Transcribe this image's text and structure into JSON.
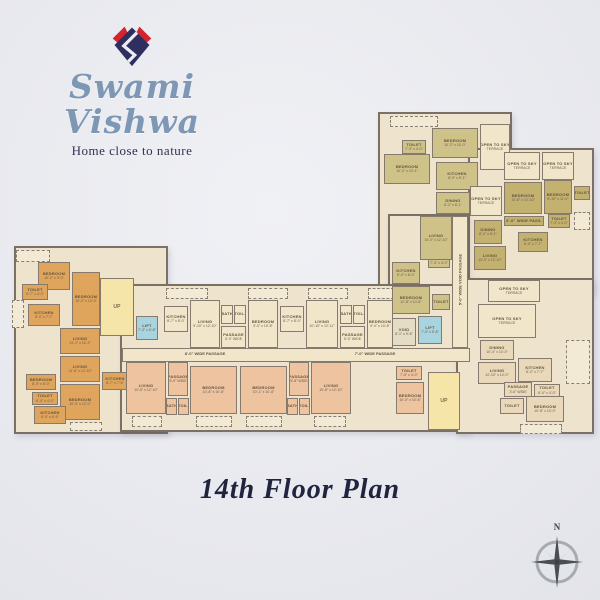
{
  "brand": {
    "name": "Swami Vishwa",
    "tagline": "Home close to nature",
    "logo_navy": "#2e2f5e",
    "logo_red": "#d6232d"
  },
  "title": "14th Floor Plan",
  "compass": {
    "north_label": "N"
  },
  "palette": {
    "or": "#dfa55c",
    "cr": "#f1e5ca",
    "sa": "#edc3a0",
    "ol": "#cfc289",
    "kh": "#c3b170",
    "tn": "#e9d9ba",
    "st": "#f6e5a9",
    "lf": "#a7d4df",
    "vd": "#e5dcc6"
  },
  "plan": {
    "slabs": [
      {
        "x": 378,
        "y": 112,
        "w": 134,
        "h": 176
      },
      {
        "x": 468,
        "y": 148,
        "w": 126,
        "h": 146
      },
      {
        "x": 388,
        "y": 214,
        "w": 80,
        "h": 74
      },
      {
        "x": 14,
        "y": 246,
        "w": 154,
        "h": 188
      },
      {
        "x": 120,
        "y": 284,
        "w": 350,
        "h": 148
      },
      {
        "x": 456,
        "y": 278,
        "w": 138,
        "h": 156
      }
    ],
    "rooms": [
      {
        "l": "BEDROOM",
        "d": "10'-2\" x 9'-0\"",
        "x": 38,
        "y": 262,
        "w": 32,
        "h": 28,
        "f": "or"
      },
      {
        "l": "BEDROOM",
        "d": "10'-2\" x 13'-0\"",
        "x": 72,
        "y": 272,
        "w": 28,
        "h": 54,
        "f": "or"
      },
      {
        "l": "TOILET",
        "d": "6'-7\" x 4'-0\"",
        "x": 22,
        "y": 284,
        "w": 26,
        "h": 16,
        "f": "or"
      },
      {
        "l": "KITCHEN",
        "d": "8'-0\" x 7'-7\"",
        "x": 28,
        "y": 304,
        "w": 32,
        "h": 22,
        "f": "or"
      },
      {
        "l": "LIVING",
        "d": "13'-1\" x 16'-2\"",
        "x": 60,
        "y": 328,
        "w": 40,
        "h": 26,
        "f": "or"
      },
      {
        "l": "LIVING",
        "d": "13'-8\" x 12'-10\"",
        "x": 60,
        "y": 356,
        "w": 40,
        "h": 26,
        "f": "or"
      },
      {
        "l": "BEDROOM",
        "d": "10'-9\" x 12'-0\"",
        "x": 60,
        "y": 384,
        "w": 40,
        "h": 36,
        "f": "or"
      },
      {
        "l": "BEDROOM",
        "d": "8'-0\" x 8'-0\"",
        "x": 26,
        "y": 374,
        "w": 30,
        "h": 16,
        "f": "or"
      },
      {
        "l": "TOILET",
        "d": "6'-0\" x 4'-0\"",
        "x": 32,
        "y": 392,
        "w": 26,
        "h": 13,
        "f": "or"
      },
      {
        "l": "KITCHEN",
        "d": "8'-0\" x 6'-6\"",
        "x": 34,
        "y": 406,
        "w": 32,
        "h": 18,
        "f": "or"
      },
      {
        "l": "KITCHEN",
        "d": "8'-7\" x 7'-5\"",
        "x": 102,
        "y": 372,
        "w": 26,
        "h": 18,
        "f": "or"
      },
      {
        "l": "UP",
        "d": "",
        "x": 100,
        "y": 278,
        "w": 34,
        "h": 58,
        "f": "st",
        "kind": "stair"
      },
      {
        "l": "LIFT",
        "d": "7'-3\" x 5'-8\"",
        "x": 136,
        "y": 316,
        "w": 22,
        "h": 24,
        "f": "lf"
      },
      {
        "l": "KITCHEN",
        "d": "8'-7\" x 8'-0\"",
        "x": 164,
        "y": 306,
        "w": 24,
        "h": 26,
        "f": "cr"
      },
      {
        "l": "LIVING",
        "d": "9'-10\" x 12'-10\"",
        "x": 190,
        "y": 300,
        "w": 30,
        "h": 48,
        "f": "cr"
      },
      {
        "l": "BATH",
        "d": "",
        "x": 221,
        "y": 305,
        "w": 12,
        "h": 19,
        "f": "cr"
      },
      {
        "l": "TOIL.",
        "d": "",
        "x": 234,
        "y": 305,
        "w": 12,
        "h": 19,
        "f": "cr"
      },
      {
        "l": "PASSAGE",
        "d": "5'-0\" WIDE",
        "x": 221,
        "y": 326,
        "w": 25,
        "h": 22,
        "f": "cr"
      },
      {
        "l": "BEDROOM",
        "d": "9'-0\" x 10'-8\"",
        "x": 248,
        "y": 300,
        "w": 30,
        "h": 48,
        "f": "cr"
      },
      {
        "l": "KITCHEN",
        "d": "8'-7\" x 8'-0\"",
        "x": 280,
        "y": 306,
        "w": 24,
        "h": 26,
        "f": "cr"
      },
      {
        "l": "LIVING",
        "d": "10'-10\" x 12'-11\"",
        "x": 306,
        "y": 300,
        "w": 32,
        "h": 48,
        "f": "cr"
      },
      {
        "l": "BATH",
        "d": "",
        "x": 340,
        "y": 305,
        "w": 12,
        "h": 19,
        "f": "cr"
      },
      {
        "l": "TOIL.",
        "d": "",
        "x": 353,
        "y": 305,
        "w": 12,
        "h": 19,
        "f": "cr"
      },
      {
        "l": "PASSAGE",
        "d": "5'-0\" WIDE",
        "x": 340,
        "y": 326,
        "w": 25,
        "h": 22,
        "f": "cr"
      },
      {
        "l": "BEDROOM",
        "d": "9'-0\" x 10'-8\"",
        "x": 367,
        "y": 300,
        "w": 26,
        "h": 48,
        "f": "cr"
      },
      {
        "l": "",
        "d": "",
        "x": 122,
        "y": 348,
        "w": 348,
        "h": 14,
        "f": "cr"
      },
      {
        "l": "LIVING",
        "d": "10'-8\" x 12'-10\"",
        "x": 126,
        "y": 362,
        "w": 40,
        "h": 52,
        "f": "sa"
      },
      {
        "l": "PASSAGE",
        "d": "5'-0\" WIDE",
        "x": 168,
        "y": 362,
        "w": 20,
        "h": 34,
        "f": "sa"
      },
      {
        "l": "BATH",
        "d": "",
        "x": 166,
        "y": 398,
        "w": 11,
        "h": 17,
        "f": "sa"
      },
      {
        "l": "TOIL.",
        "d": "",
        "x": 178,
        "y": 398,
        "w": 11,
        "h": 17,
        "f": "sa"
      },
      {
        "l": "BEDROOM",
        "d": "10'-8\" x 10'-8\"",
        "x": 190,
        "y": 366,
        "w": 47,
        "h": 48,
        "f": "sa"
      },
      {
        "l": "BEDROOM",
        "d": "10'-1\" x 10'-8\"",
        "x": 240,
        "y": 366,
        "w": 47,
        "h": 48,
        "f": "sa"
      },
      {
        "l": "PASSAGE",
        "d": "5'-8\" WIDE",
        "x": 289,
        "y": 362,
        "w": 20,
        "h": 34,
        "f": "sa"
      },
      {
        "l": "BATH",
        "d": "",
        "x": 287,
        "y": 398,
        "w": 11,
        "h": 17,
        "f": "sa"
      },
      {
        "l": "TOIL.",
        "d": "",
        "x": 299,
        "y": 398,
        "w": 11,
        "h": 17,
        "f": "sa"
      },
      {
        "l": "LIVING",
        "d": "10'-8\" x 12'-10\"",
        "x": 311,
        "y": 362,
        "w": 40,
        "h": 52,
        "f": "sa"
      },
      {
        "l": "TOILET",
        "d": "7'-5\" x 4'-0\"",
        "x": 396,
        "y": 366,
        "w": 26,
        "h": 14,
        "f": "sa"
      },
      {
        "l": "BEDROOM",
        "d": "10'-0\" x 10'-6\"",
        "x": 396,
        "y": 382,
        "w": 28,
        "h": 32,
        "f": "sa"
      },
      {
        "l": "UP",
        "d": "",
        "x": 428,
        "y": 372,
        "w": 32,
        "h": 58,
        "f": "st",
        "kind": "stair"
      },
      {
        "l": "KITCHEN",
        "d": "8'-0\" x 8'-0\"",
        "x": 392,
        "y": 262,
        "w": 28,
        "h": 22,
        "f": "ol"
      },
      {
        "l": "TOILET",
        "d": "7'-3\" x 4'-0\"",
        "x": 428,
        "y": 254,
        "w": 22,
        "h": 14,
        "f": "ol"
      },
      {
        "l": "BEDROOM",
        "d": "11'-8\" x 10'-8\"",
        "x": 392,
        "y": 286,
        "w": 38,
        "h": 28,
        "f": "ol"
      },
      {
        "l": "TOILET",
        "d": "",
        "x": 432,
        "y": 294,
        "w": 18,
        "h": 16,
        "f": "ol"
      },
      {
        "l": "VOID",
        "d": "8'-1\" x 9'-8\"",
        "x": 392,
        "y": 318,
        "w": 24,
        "h": 28,
        "f": "vd"
      },
      {
        "l": "LIFT",
        "d": "7'-3\" x 5'-8\"",
        "x": 418,
        "y": 316,
        "w": 24,
        "h": 28,
        "f": "lf"
      },
      {
        "l": "",
        "d": "",
        "x": 452,
        "y": 216,
        "w": 16,
        "h": 132,
        "f": "cr"
      },
      {
        "l": "BEDROOM",
        "d": "10'-2\" x 10'-0\"",
        "x": 432,
        "y": 128,
        "w": 46,
        "h": 30,
        "f": "ol"
      },
      {
        "l": "TOILET",
        "d": "7'-3\" x 4'-0\"",
        "x": 402,
        "y": 140,
        "w": 24,
        "h": 14,
        "f": "ol"
      },
      {
        "l": "BEDROOM",
        "d": "10'-2\" x 10'-1\"",
        "x": 384,
        "y": 154,
        "w": 46,
        "h": 30,
        "f": "ol"
      },
      {
        "l": "KITCHEN",
        "d": "8'-0\" x 8'-1\"",
        "x": 436,
        "y": 162,
        "w": 42,
        "h": 28,
        "f": "ol"
      },
      {
        "l": "DINING",
        "d": "8'-2\" x 8'-1\"",
        "x": 436,
        "y": 192,
        "w": 34,
        "h": 22,
        "f": "ol"
      },
      {
        "l": "LIVING",
        "d": "10'-0\" x 12'-10\"",
        "x": 420,
        "y": 216,
        "w": 32,
        "h": 44,
        "f": "ol"
      },
      {
        "l": "OPEN TO SKY",
        "d": "TERRACE",
        "x": 480,
        "y": 124,
        "w": 30,
        "h": 46,
        "f": "cr"
      },
      {
        "l": "OPEN TO SKY",
        "d": "TERRACE",
        "x": 504,
        "y": 152,
        "w": 36,
        "h": 28,
        "f": "cr"
      },
      {
        "l": "OPEN TO SKY",
        "d": "TERRACE",
        "x": 542,
        "y": 152,
        "w": 32,
        "h": 28,
        "f": "cr"
      },
      {
        "l": "OPEN TO SKY",
        "d": "TERRACE",
        "x": 470,
        "y": 186,
        "w": 32,
        "h": 30,
        "f": "cr"
      },
      {
        "l": "BEDROOM",
        "d": "10'-8\" x 10'-10\"",
        "x": 504,
        "y": 182,
        "w": 38,
        "h": 32,
        "f": "kh"
      },
      {
        "l": "BEDROOM",
        "d": "8'-10\" x 11'-0\"",
        "x": 544,
        "y": 180,
        "w": 28,
        "h": 34,
        "f": "kh"
      },
      {
        "l": "TOILET",
        "d": "",
        "x": 574,
        "y": 186,
        "w": 16,
        "h": 14,
        "f": "kh"
      },
      {
        "l": "3'-0\" WIDE PASS.",
        "d": "",
        "x": 504,
        "y": 216,
        "w": 40,
        "h": 10,
        "f": "kh"
      },
      {
        "l": "TOILET",
        "d": "7'-3\" x 4'-0\"",
        "x": 548,
        "y": 214,
        "w": 22,
        "h": 14,
        "f": "kh"
      },
      {
        "l": "DINING",
        "d": "8'-2\" x 8'-1\"",
        "x": 474,
        "y": 220,
        "w": 28,
        "h": 24,
        "f": "kh"
      },
      {
        "l": "KITCHEN",
        "d": "8'-0\" x 7'-7\"",
        "x": 518,
        "y": 232,
        "w": 30,
        "h": 20,
        "f": "kh"
      },
      {
        "l": "LIVING",
        "d": "10'-0\" x 12'-10\"",
        "x": 474,
        "y": 246,
        "w": 32,
        "h": 24,
        "f": "kh"
      },
      {
        "l": "OPEN TO SKY",
        "d": "TERRACE",
        "x": 488,
        "y": 280,
        "w": 52,
        "h": 22,
        "f": "cr"
      },
      {
        "l": "OPEN TO SKY",
        "d": "TERRACE",
        "x": 478,
        "y": 304,
        "w": 58,
        "h": 34,
        "f": "cr"
      },
      {
        "l": "DINING",
        "d": "10'-4\" x 10'-0\"",
        "x": 480,
        "y": 340,
        "w": 34,
        "h": 20,
        "f": "tn"
      },
      {
        "l": "LIVING",
        "d": "10'-10\" x 10'-0\"",
        "x": 478,
        "y": 362,
        "w": 38,
        "h": 22,
        "f": "tn"
      },
      {
        "l": "KITCHEN",
        "d": "8'-2\" x 7'-7\"",
        "x": 518,
        "y": 358,
        "w": 34,
        "h": 24,
        "f": "tn"
      },
      {
        "l": "TOILET",
        "d": "6'-0\" x 4'-0\"",
        "x": 534,
        "y": 384,
        "w": 26,
        "h": 13,
        "f": "tn"
      },
      {
        "l": "PASSAGE",
        "d": "3'-6\" WIDE",
        "x": 504,
        "y": 382,
        "w": 28,
        "h": 15,
        "f": "tn"
      },
      {
        "l": "TOILET",
        "d": "",
        "x": 500,
        "y": 398,
        "w": 24,
        "h": 16,
        "f": "tn"
      },
      {
        "l": "BEDROOM",
        "d": "10'-8\" x 10'-0\"",
        "x": 526,
        "y": 396,
        "w": 38,
        "h": 26,
        "f": "tn"
      }
    ],
    "balconies": [
      {
        "x": 16,
        "y": 250,
        "w": 34,
        "h": 12
      },
      {
        "x": 12,
        "y": 300,
        "w": 12,
        "h": 28
      },
      {
        "x": 166,
        "y": 288,
        "w": 42,
        "h": 11
      },
      {
        "x": 248,
        "y": 288,
        "w": 40,
        "h": 11
      },
      {
        "x": 308,
        "y": 288,
        "w": 40,
        "h": 11
      },
      {
        "x": 368,
        "y": 288,
        "w": 26,
        "h": 11
      },
      {
        "x": 132,
        "y": 416,
        "w": 30,
        "h": 11
      },
      {
        "x": 196,
        "y": 416,
        "w": 36,
        "h": 11
      },
      {
        "x": 246,
        "y": 416,
        "w": 36,
        "h": 11
      },
      {
        "x": 314,
        "y": 416,
        "w": 32,
        "h": 11
      },
      {
        "x": 390,
        "y": 116,
        "w": 48,
        "h": 11
      },
      {
        "x": 574,
        "y": 212,
        "w": 16,
        "h": 18
      },
      {
        "x": 566,
        "y": 340,
        "w": 24,
        "h": 44
      },
      {
        "x": 520,
        "y": 424,
        "w": 42,
        "h": 10
      },
      {
        "x": 70,
        "y": 422,
        "w": 32,
        "h": 9
      }
    ],
    "labels": [
      {
        "t": "8'-0\" WIDE PASSAGE",
        "x": 150,
        "y": 351,
        "w": 110,
        "rot": false
      },
      {
        "t": "7'-0\" WIDE PASSAGE",
        "x": 320,
        "y": 351,
        "w": 110,
        "rot": false
      },
      {
        "t": "5'-0\" WIDE VOID PASSAGE",
        "x": 412,
        "y": 277,
        "w": 96,
        "rot": true
      }
    ]
  }
}
